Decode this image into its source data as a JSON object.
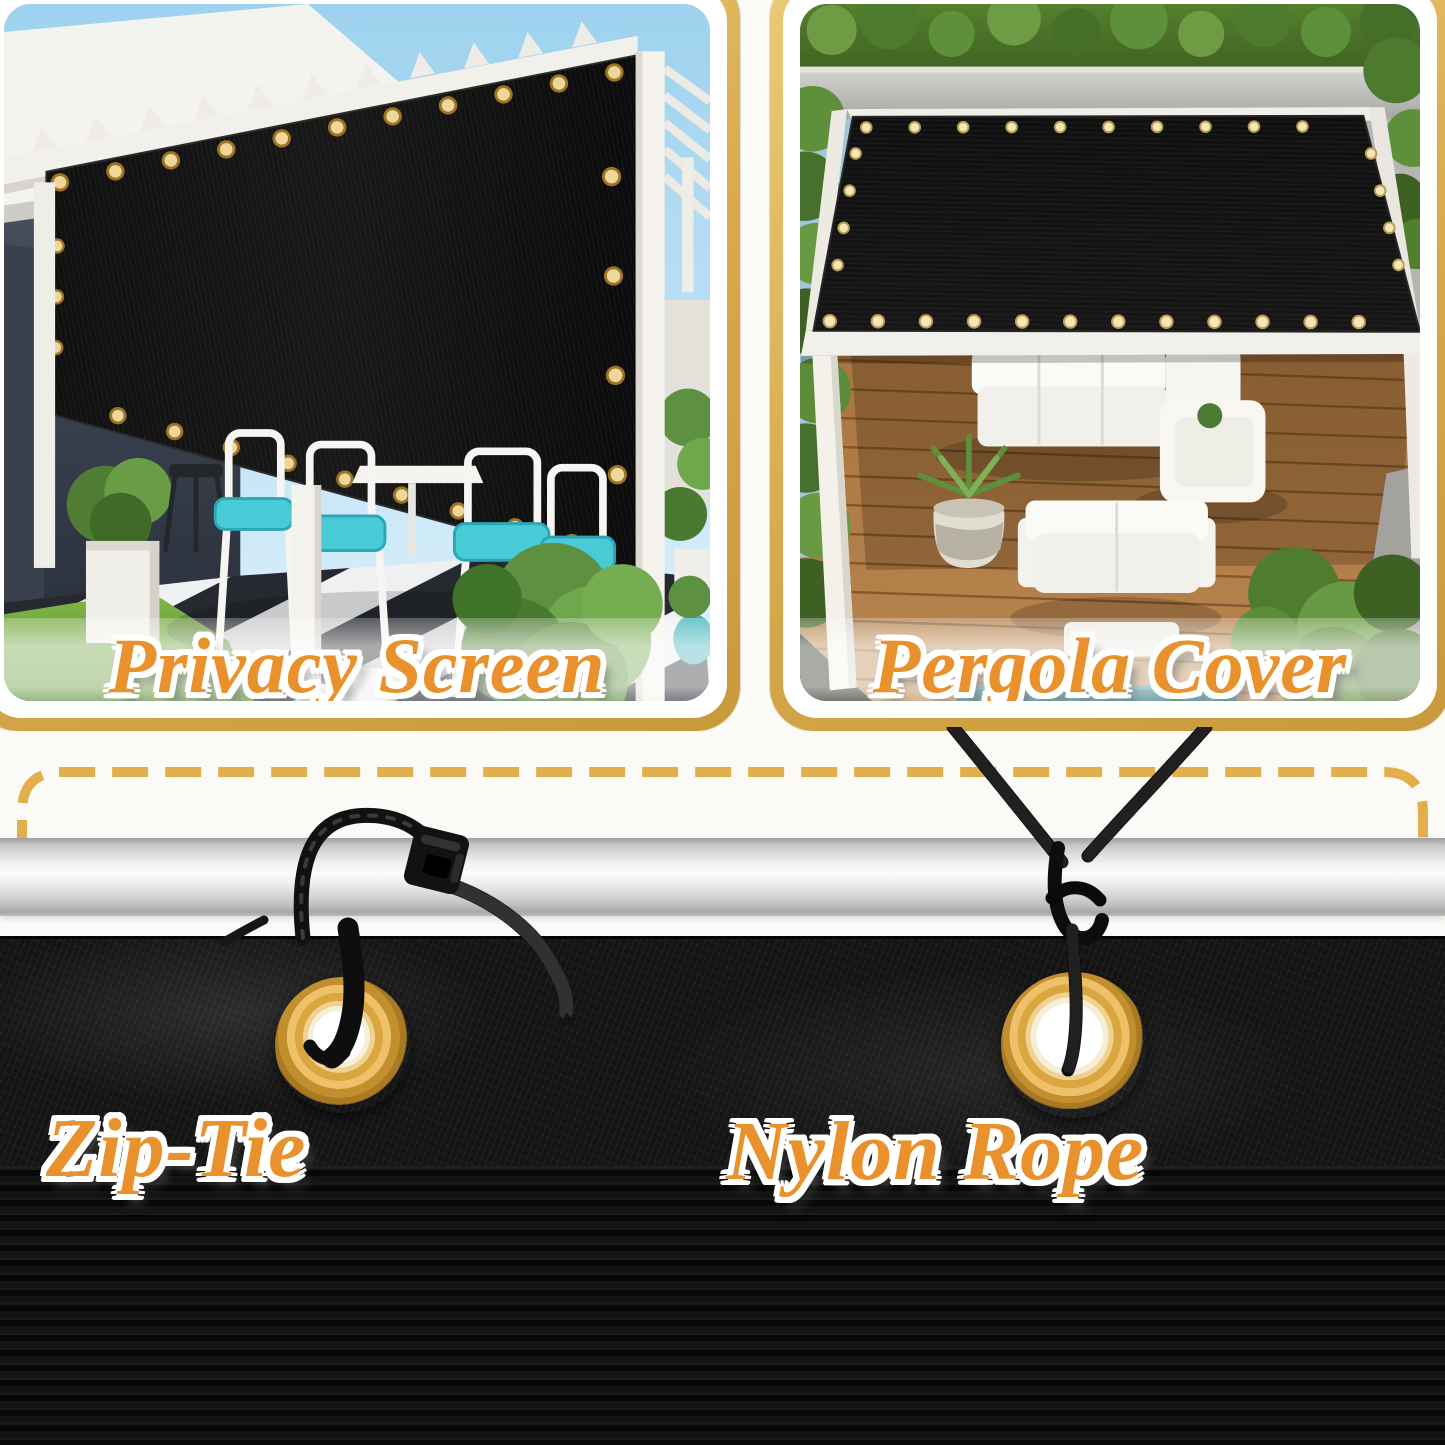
{
  "panels": [
    {
      "id": "privacy-screen",
      "label": "Privacy Screen"
    },
    {
      "id": "pergola-cover",
      "label": "Pergola Cover"
    }
  ],
  "installation": {
    "left_label": "Zip-Tie",
    "right_label": "Nylon Rope"
  },
  "icons": {
    "grommet": "grommet-ring",
    "zip_tie": "zip-tie",
    "nylon_rope": "nylon-rope"
  },
  "colors": {
    "border_gold": "#D8A94A",
    "border_gold_light": "#EACB79",
    "dash_gold": "#E3AF4D",
    "label_orange": "#E8912D",
    "label_outline": "#FFFFFF",
    "grommet_gold": "#D9A63F",
    "mesh_black": "#141414",
    "pole_silver": "#E9E9E9",
    "cushion_teal": "#49CBD7"
  }
}
